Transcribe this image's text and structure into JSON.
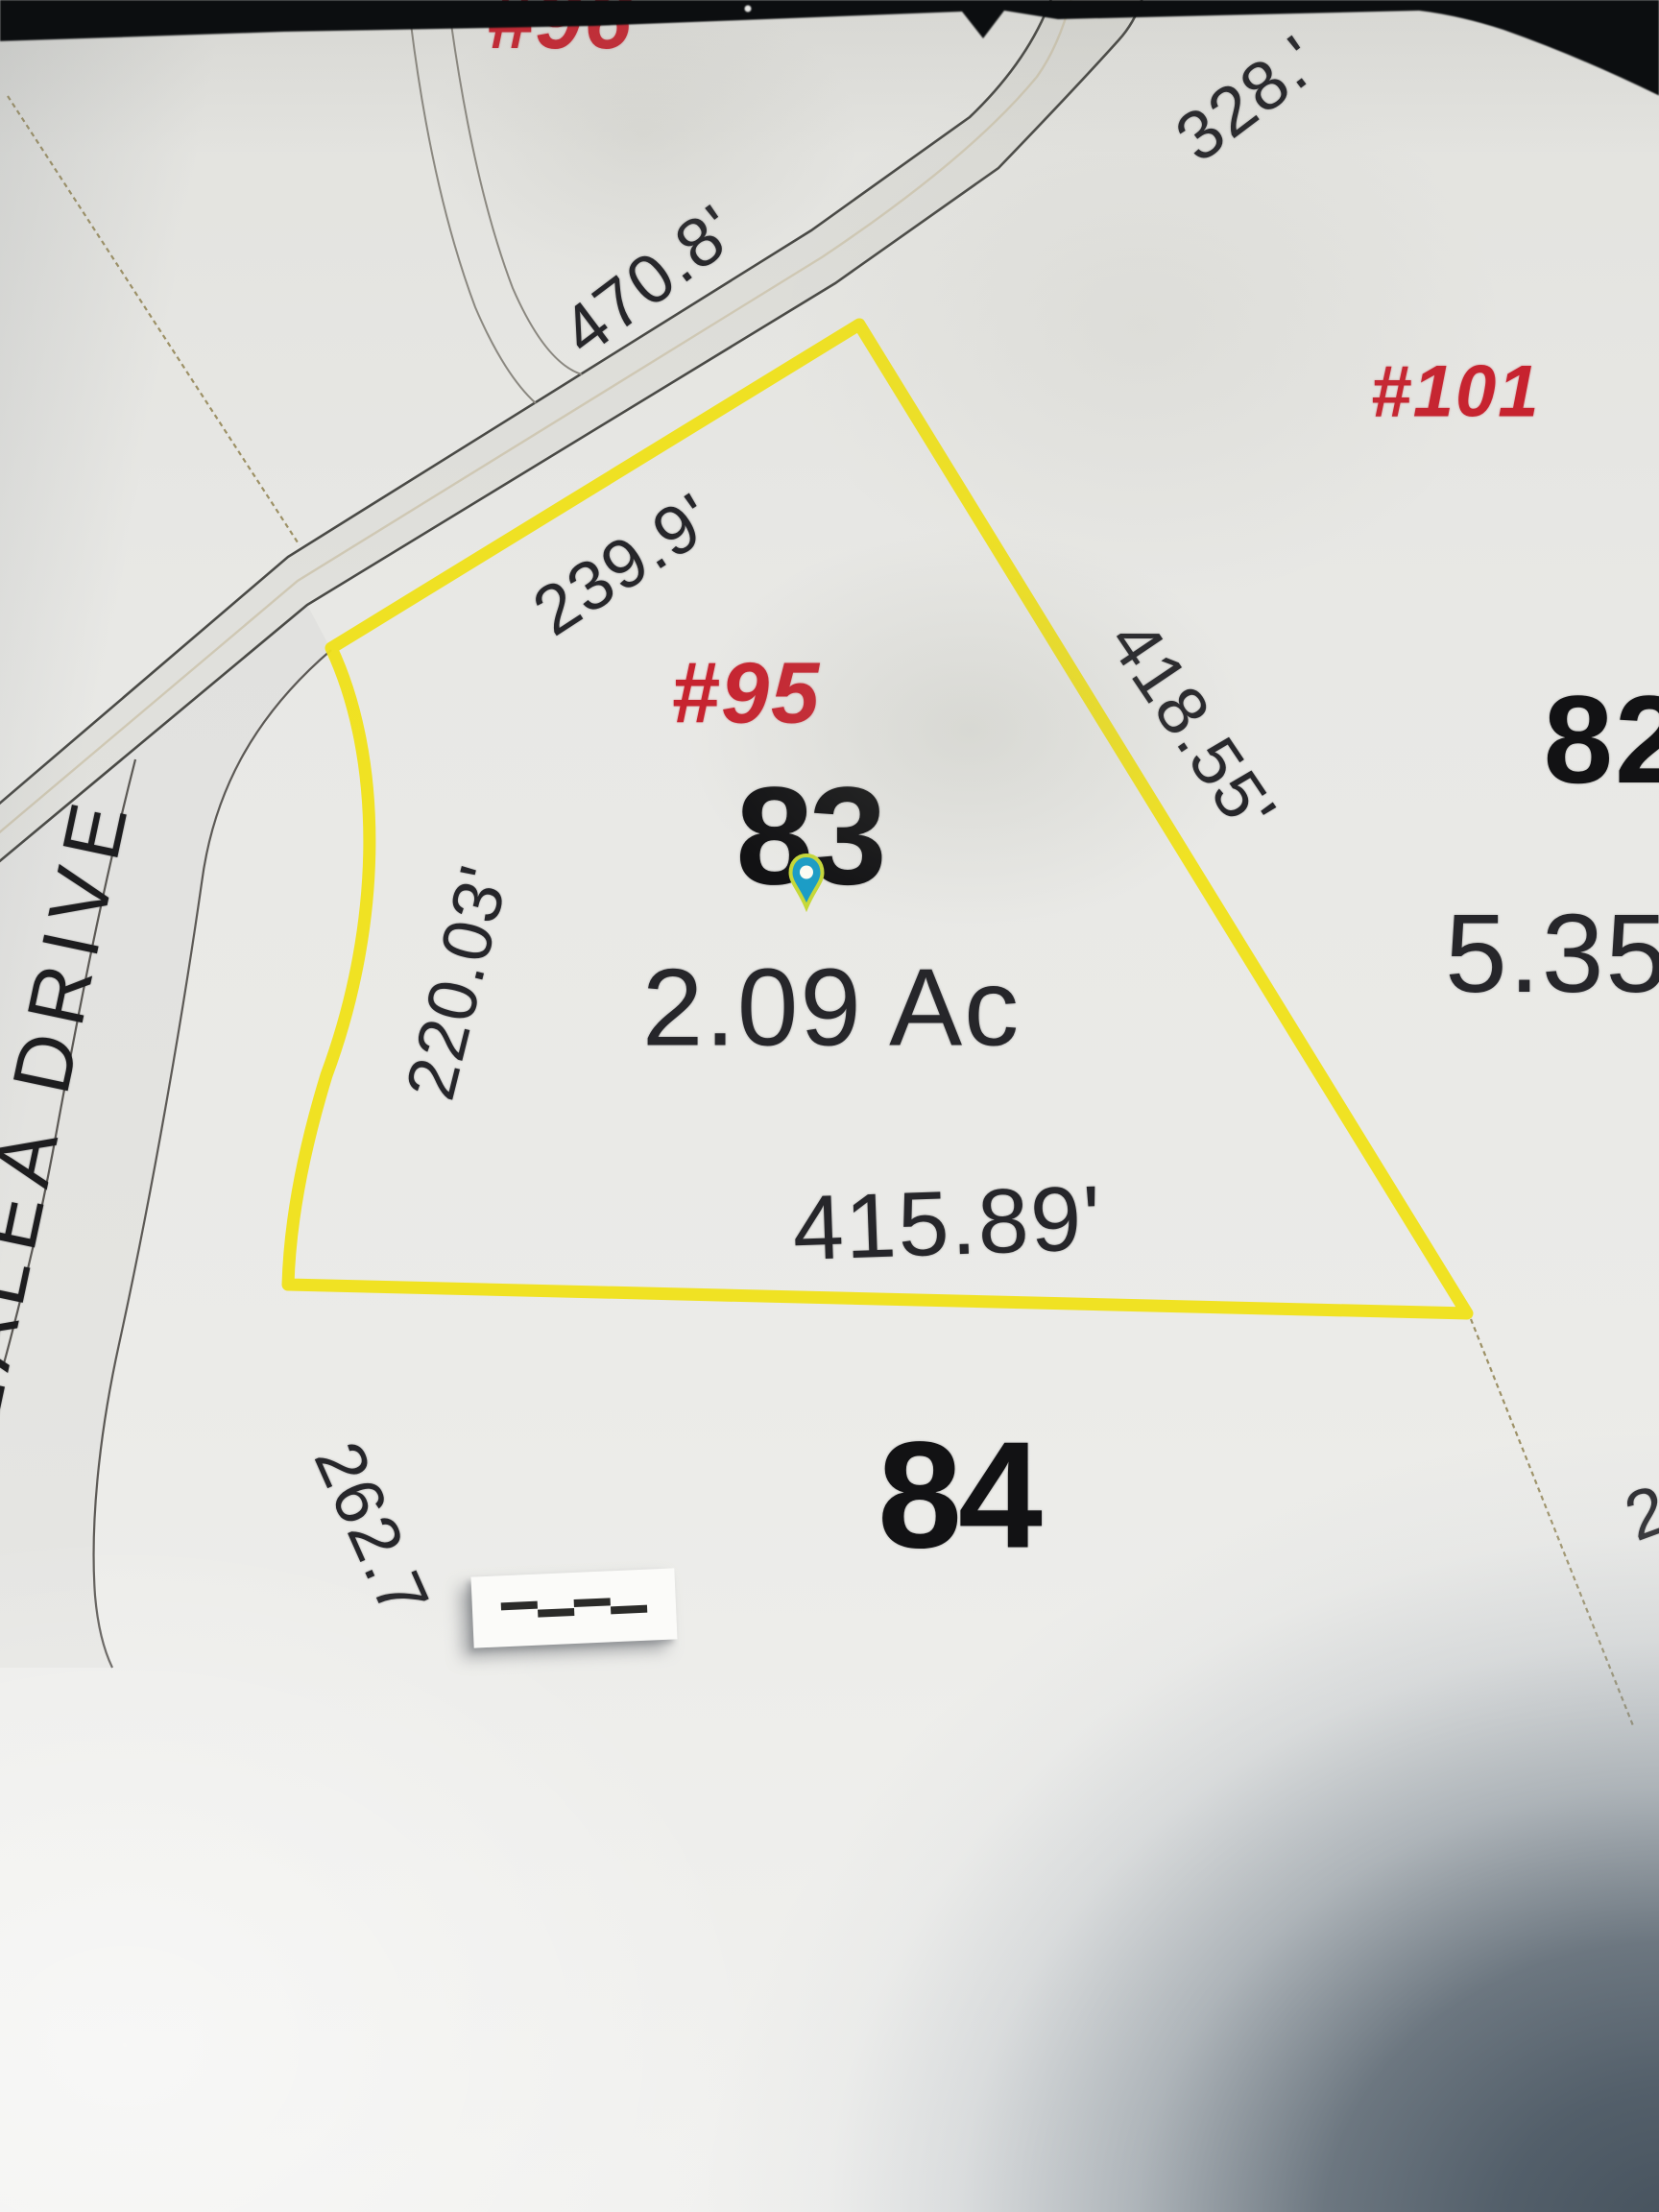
{
  "map": {
    "type": "plat-survey-photo",
    "highlight_color": "#efe11b",
    "red_label_color": "#c7232f",
    "street": {
      "name": "AZALEA DRIVE"
    },
    "target_lot": {
      "lot_number": "83",
      "site_number": "#95",
      "area": "2.09 Ac",
      "north_side": "239.9'",
      "east_side": "418.55'",
      "south_side": "415.89'",
      "west_side": "220.03'",
      "marker": {
        "name": "map-pin",
        "fill": "#1b9dc6",
        "outline": "#c6d839",
        "center": "#fdfdf4"
      }
    },
    "road_dimensions": {
      "west_segment": "470.8'",
      "east_segment": "328.'"
    },
    "neighbor_lots": {
      "right_lot_number": "82",
      "right_site_number": "#101",
      "right_area": "5.35",
      "lower_lot_number": "84",
      "upper_site_number_partial": "#96",
      "west_dimension": "262.7",
      "right_edge_partial_dimension": "2"
    },
    "scale_bar": {
      "segments": 4
    }
  }
}
